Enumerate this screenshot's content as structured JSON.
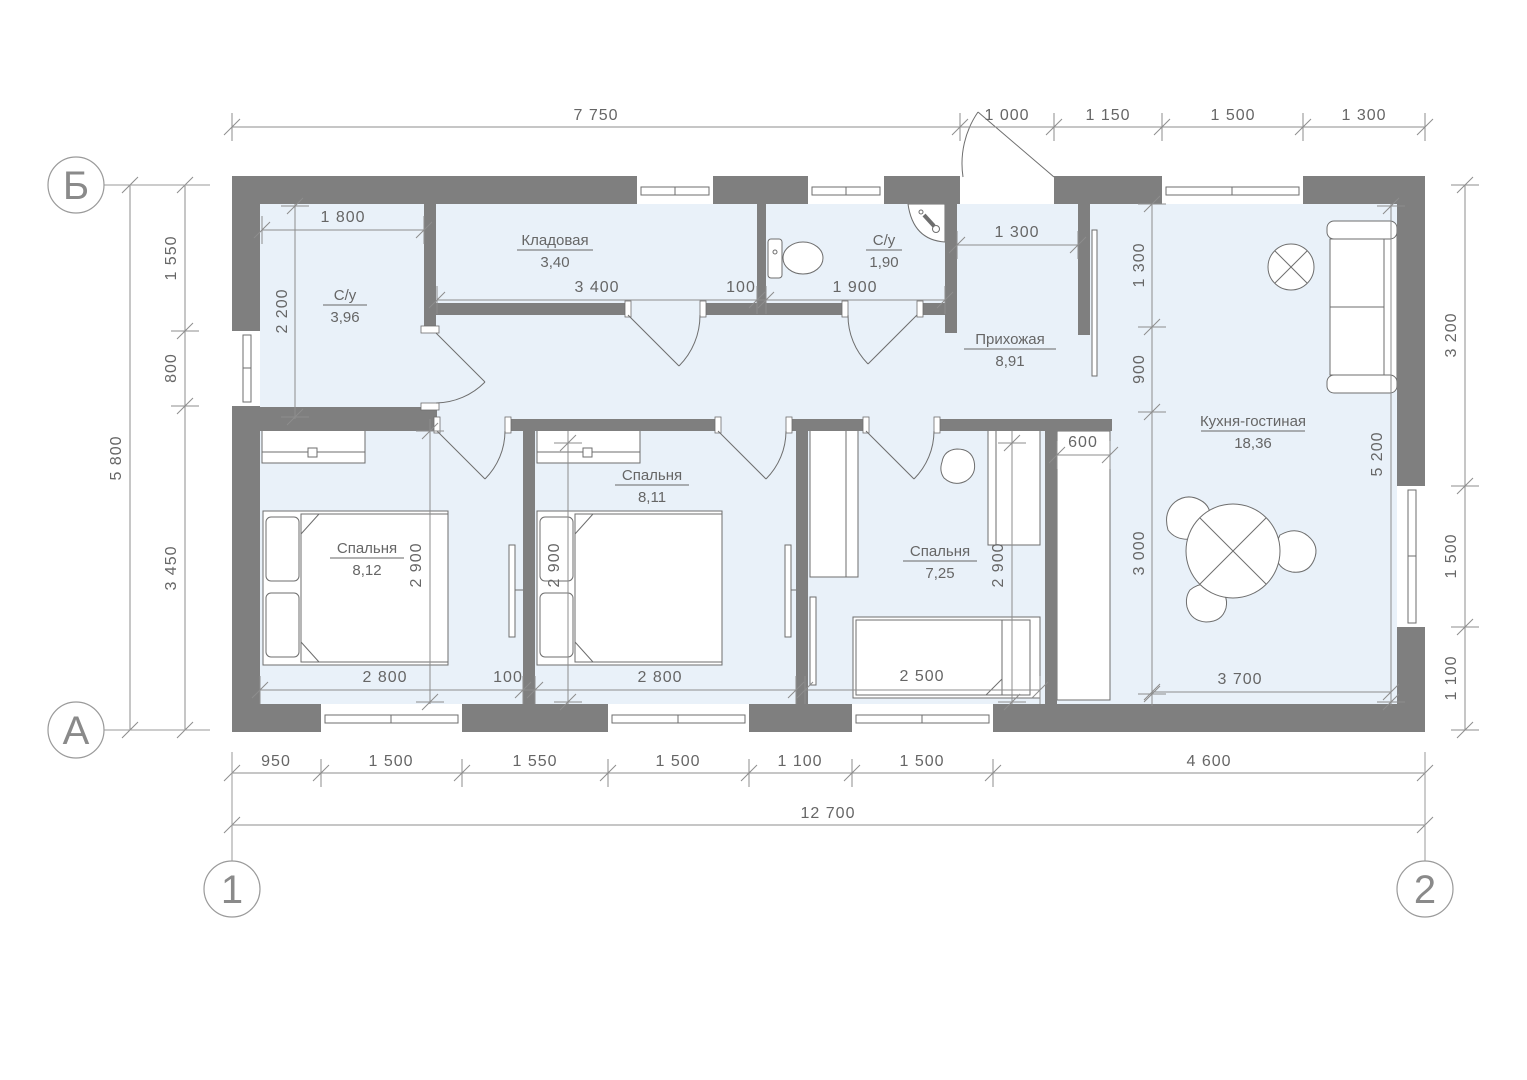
{
  "grid": {
    "row_top": "Б",
    "row_bottom": "А",
    "col_left": "1",
    "col_right": "2"
  },
  "rooms": {
    "su1": {
      "name": "С/у",
      "area": "3,96"
    },
    "storage": {
      "name": "Кладовая",
      "area": "3,40"
    },
    "su2": {
      "name": "С/у",
      "area": "1,90"
    },
    "hall": {
      "name": "Прихожая",
      "area": "8,91"
    },
    "kitchen": {
      "name": "Кухня-гостиная",
      "area": "18,36"
    },
    "bedroom1": {
      "name": "Спальня",
      "area": "8,12"
    },
    "bedroom2": {
      "name": "Спальня",
      "area": "8,11"
    },
    "bedroom3": {
      "name": "Спальня",
      "area": "7,25"
    }
  },
  "dims": {
    "top": [
      "7 750",
      "1 000",
      "1 150",
      "1 500",
      "1 300"
    ],
    "bottom": [
      "950",
      "1 500",
      "1 550",
      "1 500",
      "1 100",
      "1 500",
      "4 600"
    ],
    "bottom_total": "12 700",
    "left_outer": "5 800",
    "left": [
      "1 550",
      "800",
      "3 450"
    ],
    "right": [
      "3 200",
      "1 500",
      "1 100"
    ],
    "su1_width": "1 800",
    "su1_depth": "2 200",
    "storage_width": "3 400",
    "wall_gap": "100",
    "su2_width": "1 900",
    "hall_width": "1 300",
    "hall_vertical": [
      "1 300",
      "900",
      "3 000"
    ],
    "closet_depth": "600",
    "kitchen_height": "5 200",
    "kitchen_width": "3 700",
    "bed1_width": "2 800",
    "bed1_depth": "2 900",
    "bed_gap": "100",
    "bed2_width": "2 800",
    "bed2_depth": "2 900",
    "bed3_length": "2 500",
    "bed3_depth": "2 900"
  },
  "colors": {
    "wall": "#7f7f7f",
    "floor": "#e9f1f9",
    "dim_line": "#8d8d8d"
  }
}
